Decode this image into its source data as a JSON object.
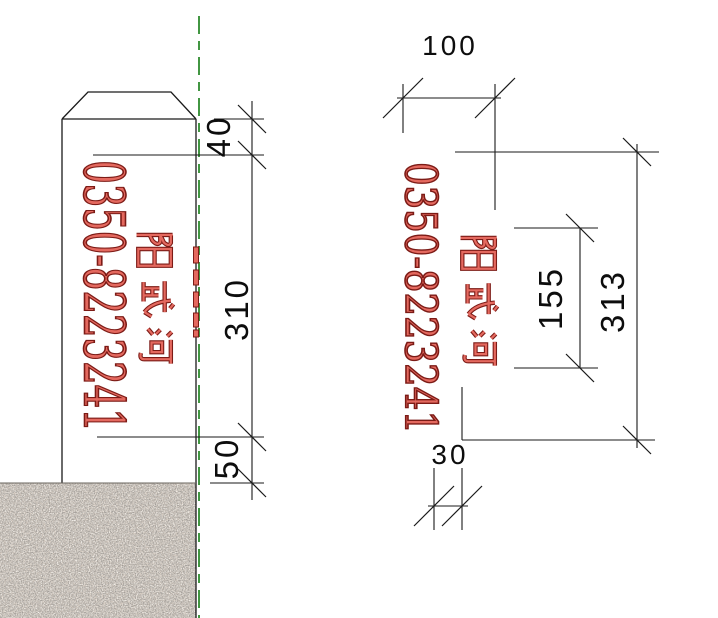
{
  "drawing": {
    "side_view": {
      "phone_number": "0350-8223241",
      "river_name": "阳武河",
      "dimensions": {
        "top_to_text": "40",
        "text_block_height": "310",
        "text_to_ground": "50"
      }
    },
    "front_view": {
      "phone_number": "0350-8223241",
      "river_name": "阳武河",
      "dimensions": {
        "post_width": "100",
        "cjk_column_height": "155",
        "text_column_height": "313",
        "column_gap": "30"
      }
    },
    "colors": {
      "label_fill": "#e4695f",
      "label_outline": "#7c1b16",
      "centerline_green": "#2e8b2e",
      "line_black": "#1a1a1a"
    }
  }
}
